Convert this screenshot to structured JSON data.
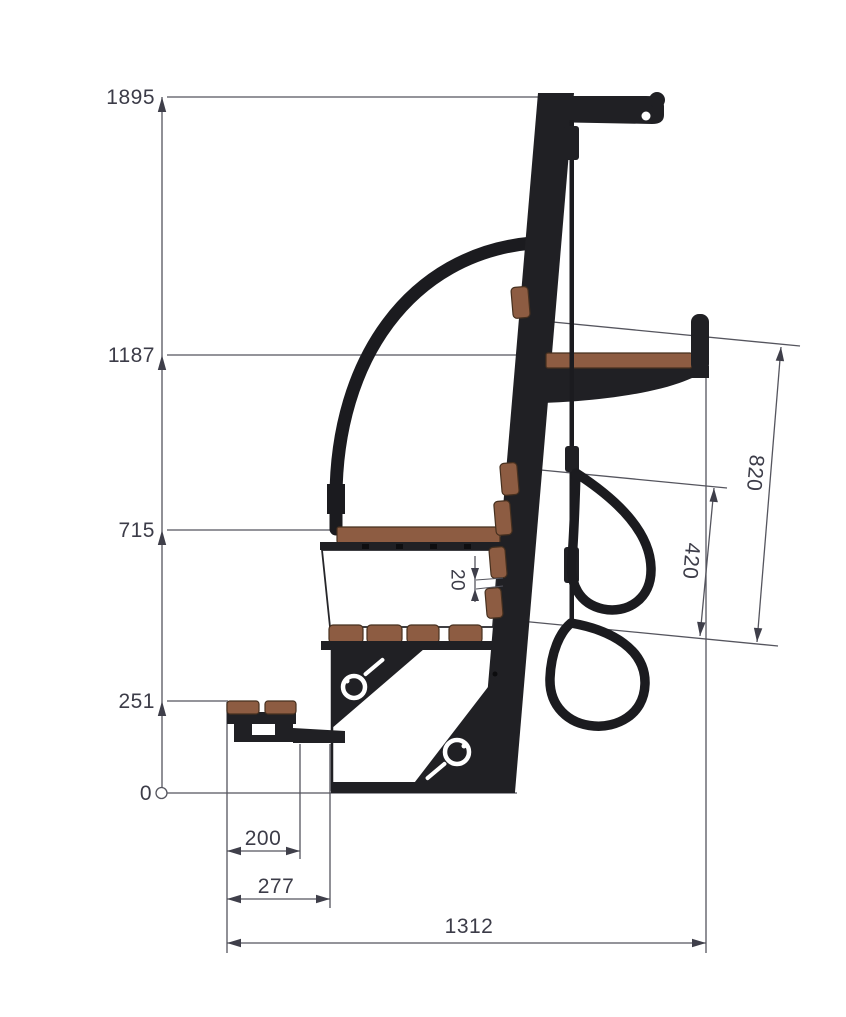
{
  "page": {
    "background": "#ffffff",
    "description": "Side-view dimensioned technical drawing of an outdoor fitness seat station with leaning mast, arched handrail, two seats, foot step and hanging exercise rings"
  },
  "colors": {
    "structure_black": "#202024",
    "wood_brown": "#8d5c42",
    "dimension_line": "#55555e",
    "dimension_text": "#3c3c48",
    "panel_white": "#ffffff"
  },
  "dimensions": {
    "heights": {
      "top": "1895",
      "upper_seat": "1187",
      "mid_seat": "715",
      "step": "251",
      "ground": "0"
    },
    "widths": {
      "step_depth": "200",
      "step_total": "277",
      "overall": "1312"
    },
    "hanging": {
      "upper_ring": "820",
      "lower_ring": "420"
    },
    "detail": {
      "pad_gap": "20"
    }
  }
}
